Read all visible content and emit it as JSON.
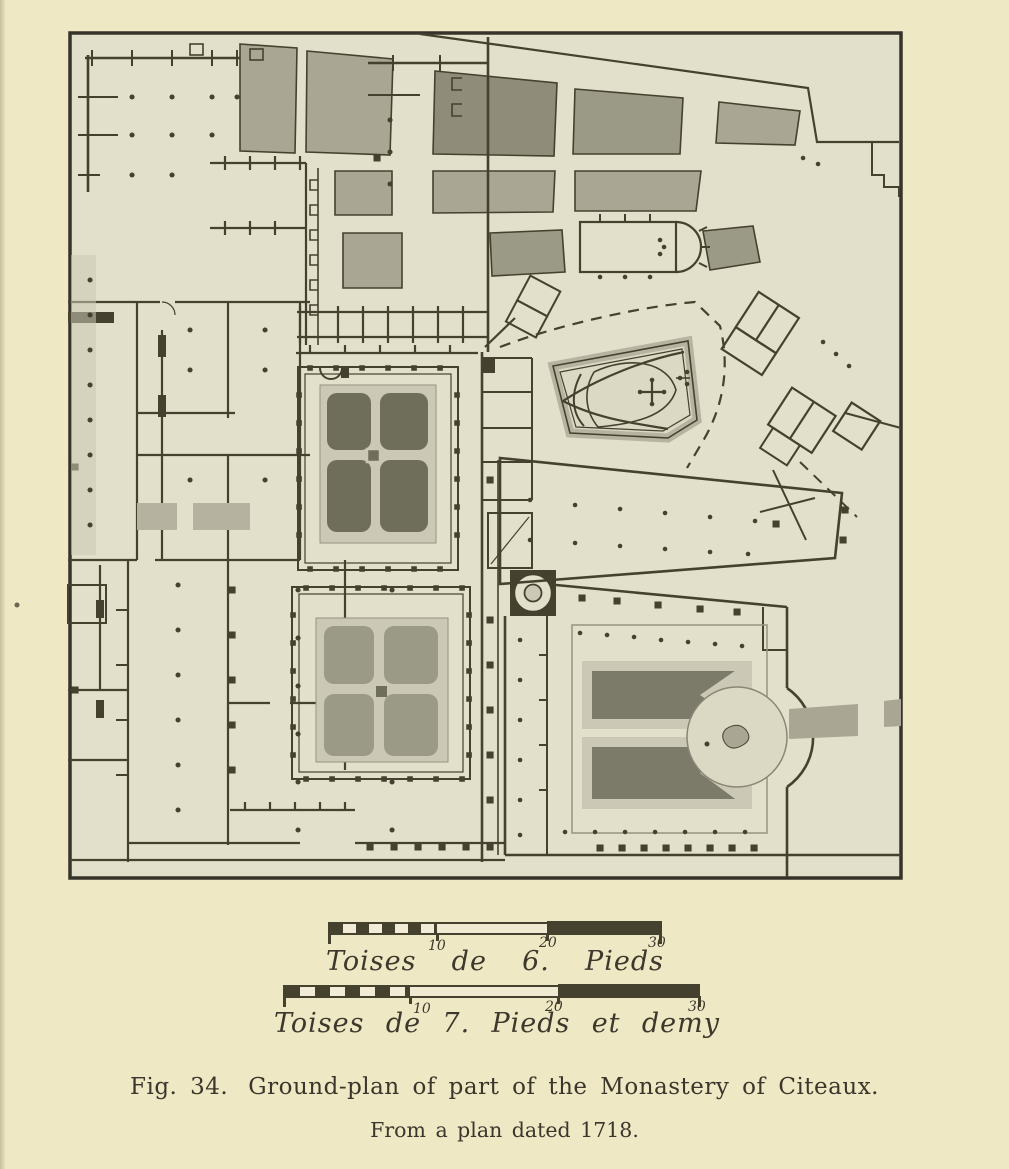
{
  "figure": {
    "caption": {
      "fig_label": "Fig. 34.",
      "title": "Ground-plan of part of the Monastery of Citeaux.",
      "source_line": "From a plan dated 1718."
    },
    "scale_bars": [
      {
        "label": "Toises de 6. Pieds",
        "words": [
          "Toises",
          "de",
          "6.",
          "Pieds"
        ],
        "ticks": [
          "10",
          "20",
          "30"
        ]
      },
      {
        "label": "Toises de 7. Pieds et demy",
        "words": [
          "Toises",
          "de",
          "7.",
          "Pieds",
          "et",
          "demy"
        ],
        "ticks": [
          "10",
          "20",
          "30"
        ]
      }
    ],
    "colors": {
      "paper": "#efe8c5",
      "plan_background": "#e2dfca",
      "ink": "#45412f",
      "garden_medium": "#a9a794",
      "garden_dark": "#8f8d7a",
      "cloister_garden_dark": "#6f6e5b",
      "cloister_garden_light": "#9b9a86",
      "path_light": "#cbc8b5",
      "parterre_dark": "#7c7b6a",
      "corridor_shade": "#b5b3a0"
    }
  }
}
